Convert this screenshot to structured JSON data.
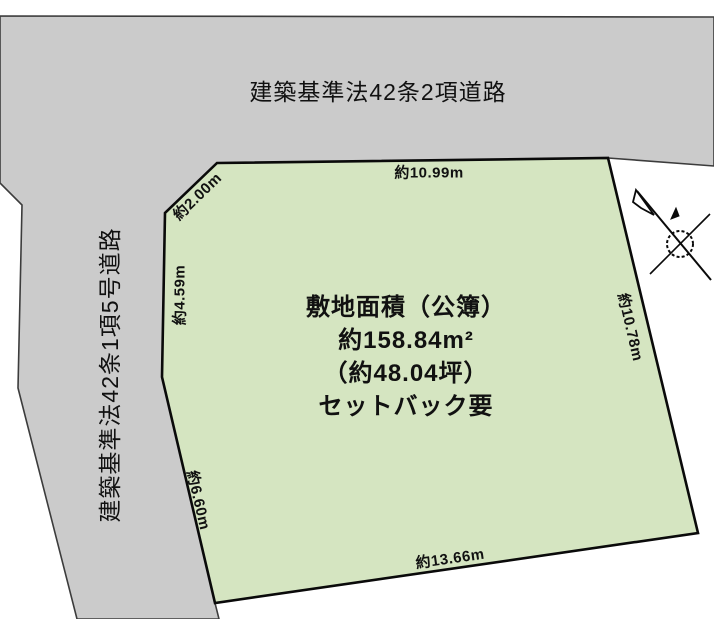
{
  "roads": {
    "top": {
      "label": "建築基準法42条2項道路"
    },
    "left": {
      "label": "建築基準法42条1項5号道路"
    }
  },
  "parcel": {
    "info": {
      "line1": "敷地面積（公簿）",
      "line2": "約158.84m²",
      "line3": "（約48.04坪）",
      "line4": "セットバック要"
    },
    "measurements": {
      "top": "約10.99m",
      "top_left": "約2.00m",
      "left": "約4.59m",
      "lower_left": "約6.60m",
      "bottom": "約13.66m",
      "right": "約10.78m"
    }
  },
  "colors": {
    "parcel_fill": "#d5e5c1",
    "road_fill": "#cbcbcb",
    "road_stroke": "#3c3c3c",
    "parcel_stroke": "#0a0a0a",
    "background": "#ffffff"
  }
}
